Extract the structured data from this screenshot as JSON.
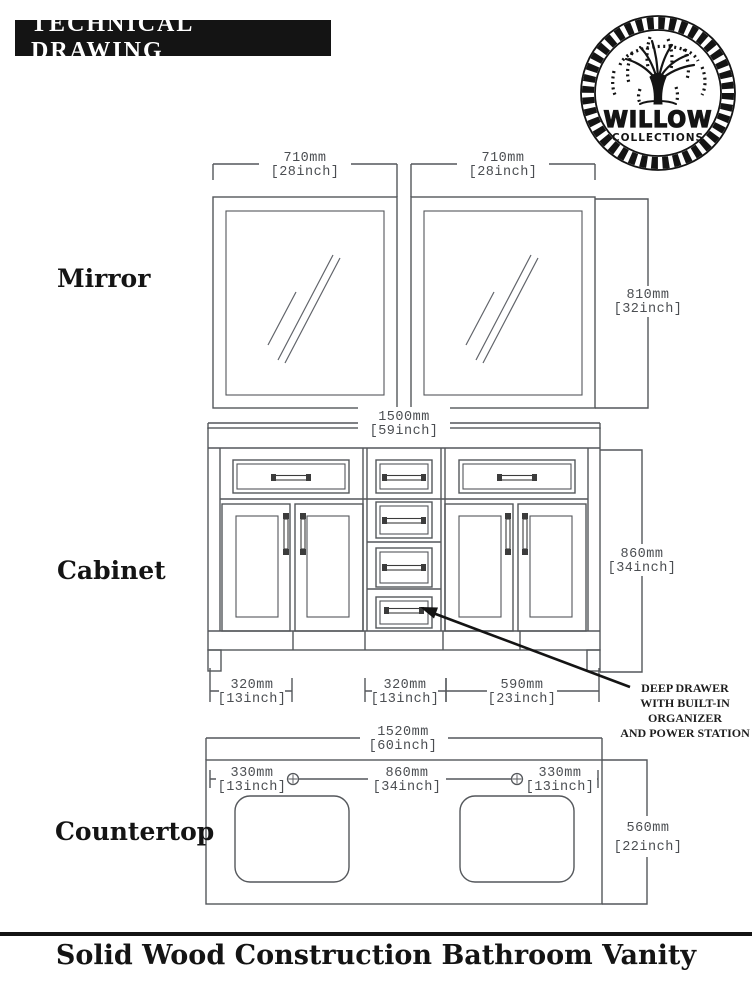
{
  "header": {
    "title": "TECHNICAL DRAWING"
  },
  "logo": {
    "brand": "WILLOW",
    "sub": "COLLECTIONS"
  },
  "sections": {
    "mirror": "Mirror",
    "cabinet": "Cabinet",
    "countertop": "Countertop"
  },
  "dimensions": {
    "mirror_width_left": {
      "mm": "710mm",
      "inch": "[28inch]"
    },
    "mirror_width_right": {
      "mm": "710mm",
      "inch": "[28inch]"
    },
    "mirror_height": {
      "mm": "810mm",
      "inch": "[32inch]"
    },
    "cabinet_width": {
      "mm": "1500mm",
      "inch": "[59inch]"
    },
    "cabinet_height": {
      "mm": "860mm",
      "inch": "[34inch]"
    },
    "cabinet_bottom_left": {
      "mm": "320mm",
      "inch": "[13inch]"
    },
    "cabinet_bottom_middle": {
      "mm": "320mm",
      "inch": "[13inch]"
    },
    "cabinet_bottom_right": {
      "mm": "590mm",
      "inch": "[23inch]"
    },
    "countertop_width": {
      "mm": "1520mm",
      "inch": "[60inch]"
    },
    "countertop_left": {
      "mm": "330mm",
      "inch": "[13inch]"
    },
    "countertop_center": {
      "mm": "860mm",
      "inch": "[34inch]"
    },
    "countertop_right": {
      "mm": "330mm",
      "inch": "[13inch]"
    },
    "countertop_depth": {
      "mm": "560mm",
      "inch": "[22inch]"
    }
  },
  "annotation": {
    "line1": "DEEP DRAWER",
    "line2": "WITH BUILT-IN",
    "line3": "ORGANIZER",
    "line4": "AND POWER STATION"
  },
  "footer": {
    "title": "Solid Wood Construction Bathroom Vanity"
  },
  "colors": {
    "ink": "#141414",
    "line": "#54575b",
    "dim-text": "#4b4e52",
    "paper": "#ffffff"
  }
}
